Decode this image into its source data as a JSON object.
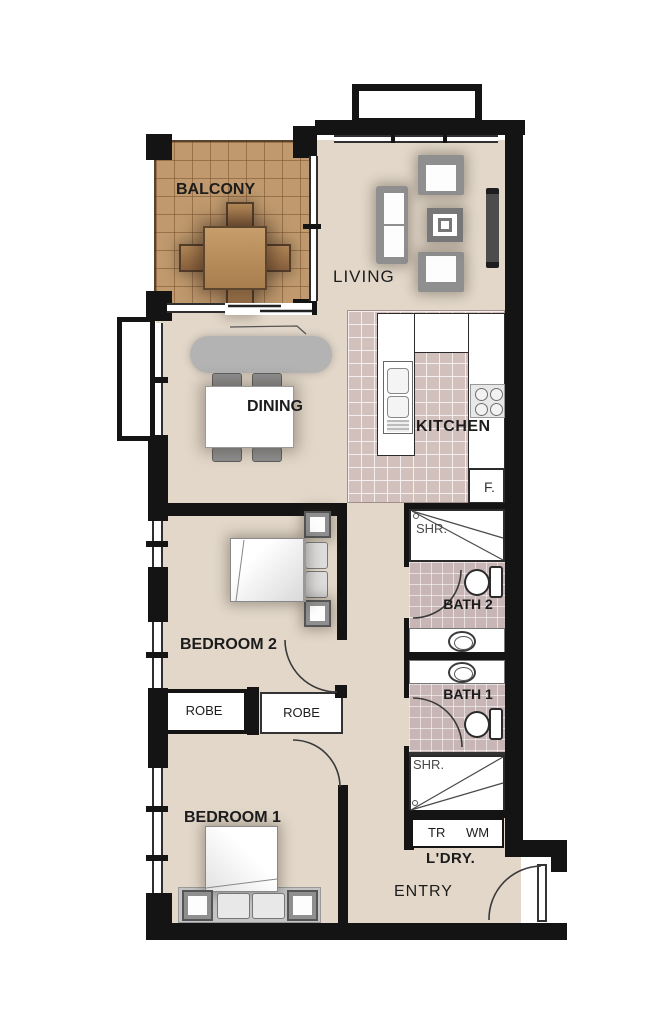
{
  "floor_plan": {
    "rooms": {
      "balcony": {
        "label": "BALCONY"
      },
      "living": {
        "label": "LIVING"
      },
      "dining": {
        "label": "DINING"
      },
      "kitchen": {
        "label": "KITCHEN",
        "fridge": "F."
      },
      "bedroom2": {
        "label": "BEDROOM 2"
      },
      "bedroom1": {
        "label": "BEDROOM 1"
      },
      "bath2": {
        "label": "BATH 2",
        "shower": "SHR."
      },
      "bath1": {
        "label": "BATH 1",
        "shower": "SHR."
      },
      "robes": {
        "left": "ROBE",
        "right": "ROBE"
      },
      "laundry": {
        "label": "L'DRY.",
        "dryer": "TR",
        "washer": "WM"
      },
      "entry": {
        "label": "ENTRY"
      }
    },
    "colors": {
      "wall": "#141414",
      "floor": "#e2d7c9",
      "balcony_deck": "#c09a6e",
      "kitchen_tile": "#d2c0bc",
      "bath_tile": "#c8b6b6",
      "furniture_gray": "#8f8f8f",
      "timber": "#b9905f"
    }
  }
}
